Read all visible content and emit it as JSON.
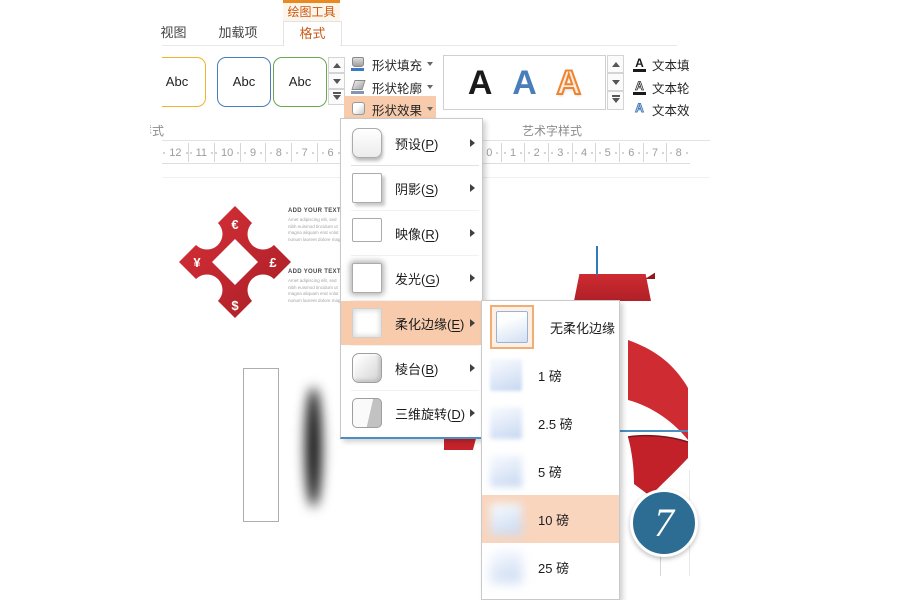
{
  "colors": {
    "accent_orange": "#e88a21",
    "accent_orange_text": "#ca5d18",
    "menu_highlight": "#f7cbac",
    "submenu_highlight": "#f9d5bd",
    "shape_red": "#c5232b",
    "circle_blue": "#2d6d94",
    "guide_blue": "#4a8ec2"
  },
  "contextual_tab_label": "绘图工具",
  "tabs": {
    "view": "视图",
    "addins": "加载项",
    "format": "格式"
  },
  "shape_styles_group": {
    "label": "形状样式",
    "gallery_items": [
      {
        "label": "Abc"
      },
      {
        "label": "Abc"
      },
      {
        "label": "Abc"
      }
    ]
  },
  "shape_buttons": {
    "fill": "形状填充",
    "outline": "形状轮廓",
    "effects": "形状效果"
  },
  "wordart_group": {
    "label": "艺术字样式",
    "letters": [
      {
        "glyph": "A"
      },
      {
        "glyph": "A"
      },
      {
        "glyph": "A"
      }
    ]
  },
  "text_buttons": {
    "fill": "文本填充",
    "outline": "文本轮廓",
    "effects": "文本效果",
    "icon_glyph": "A"
  },
  "ruler": {
    "left_numbers": [
      "12",
      "11",
      "10",
      "9",
      "8",
      "7",
      "6"
    ],
    "right_numbers": [
      "0",
      "1",
      "2",
      "3",
      "4",
      "5",
      "6",
      "7",
      "8"
    ]
  },
  "effects_menu": {
    "items": [
      {
        "pre": "预设(",
        "key": "P",
        "post": ")",
        "icon": "preset-icon"
      },
      {
        "pre": "阴影(",
        "key": "S",
        "post": ")",
        "icon": "shadow-icon"
      },
      {
        "pre": "映像(",
        "key": "R",
        "post": ")",
        "icon": "reflection-icon"
      },
      {
        "pre": "发光(",
        "key": "G",
        "post": ")",
        "icon": "glow-icon"
      },
      {
        "pre": "柔化边缘(",
        "key": "E",
        "post": ")",
        "icon": "soft-edges-icon",
        "highlight": true
      },
      {
        "pre": "棱台(",
        "key": "B",
        "post": ")",
        "icon": "bevel-icon"
      },
      {
        "pre": "三维旋转(",
        "key": "D",
        "post": ")",
        "icon": "rotation-3d-icon"
      }
    ]
  },
  "soft_edges_submenu": {
    "items": [
      {
        "label": "无柔化边缘",
        "blur": 0,
        "selected": true
      },
      {
        "label": "1 磅",
        "blur": 1.5
      },
      {
        "label": "2.5 磅",
        "blur": 2.5
      },
      {
        "label": "5 磅",
        "blur": 3.5
      },
      {
        "label": "10 磅",
        "blur": 4.5,
        "highlight": true
      },
      {
        "label": "25 磅",
        "blur": 5.5
      }
    ]
  },
  "slide": {
    "ornament_symbols": {
      "top": "€",
      "left": "¥",
      "right": "£",
      "bottom": "$"
    },
    "text_blocks": [
      {
        "heading": "ADD YOUR TEXT",
        "line1": "Amet adipiscing elit, sed",
        "line2": "nibh euismod tincidunt ut",
        "line3": "magna aliquam erat volut",
        "line4": "nonum laoreet dolore mag"
      },
      {
        "heading": "ADD YOUR TEXT",
        "line1": "Amet adipiscing elit, sed",
        "line2": "nibh euismod tincidunt ut",
        "line3": "magna aliquam erat volut",
        "line4": "nonum laoreet dolore mag"
      }
    ],
    "step_number": "7"
  }
}
